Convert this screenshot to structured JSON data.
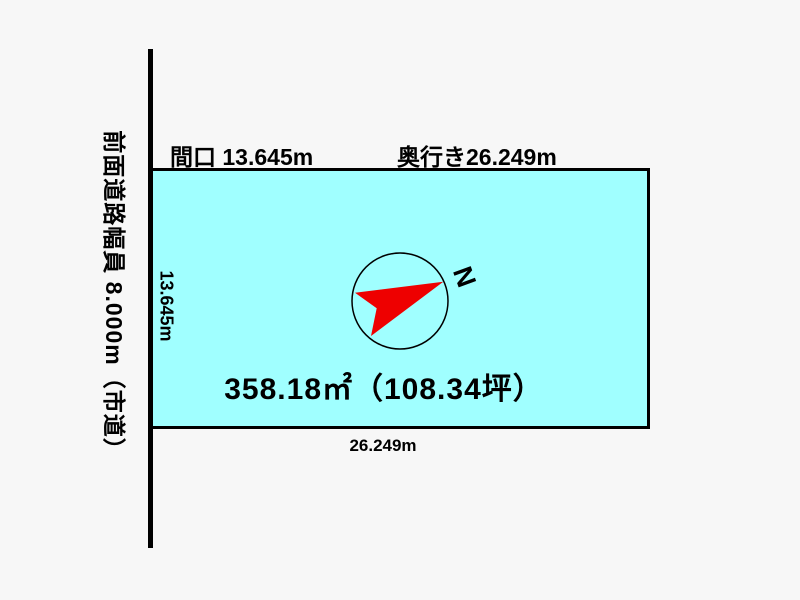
{
  "road": {
    "label": "前面道路幅員 8.000m（市道）",
    "width_m": "8.000",
    "type": "市道"
  },
  "parcel": {
    "frontage_label": "間口 13.645m",
    "depth_label": "奥行き26.249m",
    "frontage_side_label": "13.645m",
    "depth_bottom_label": "26.249m",
    "area_label": "358.18㎡（108.34坪）",
    "frontage_m": "13.645",
    "depth_m": "26.249",
    "area_sqm": "358.18",
    "area_tsubo": "108.34",
    "fill_color": "#a0ffff",
    "border_color": "#000000"
  },
  "compass": {
    "north_label": "N",
    "arrow_color": "#ee0000",
    "circle_color": "#000000"
  },
  "colors": {
    "background": "#f7f7f7",
    "text": "#000000",
    "road_line": "#000000"
  }
}
